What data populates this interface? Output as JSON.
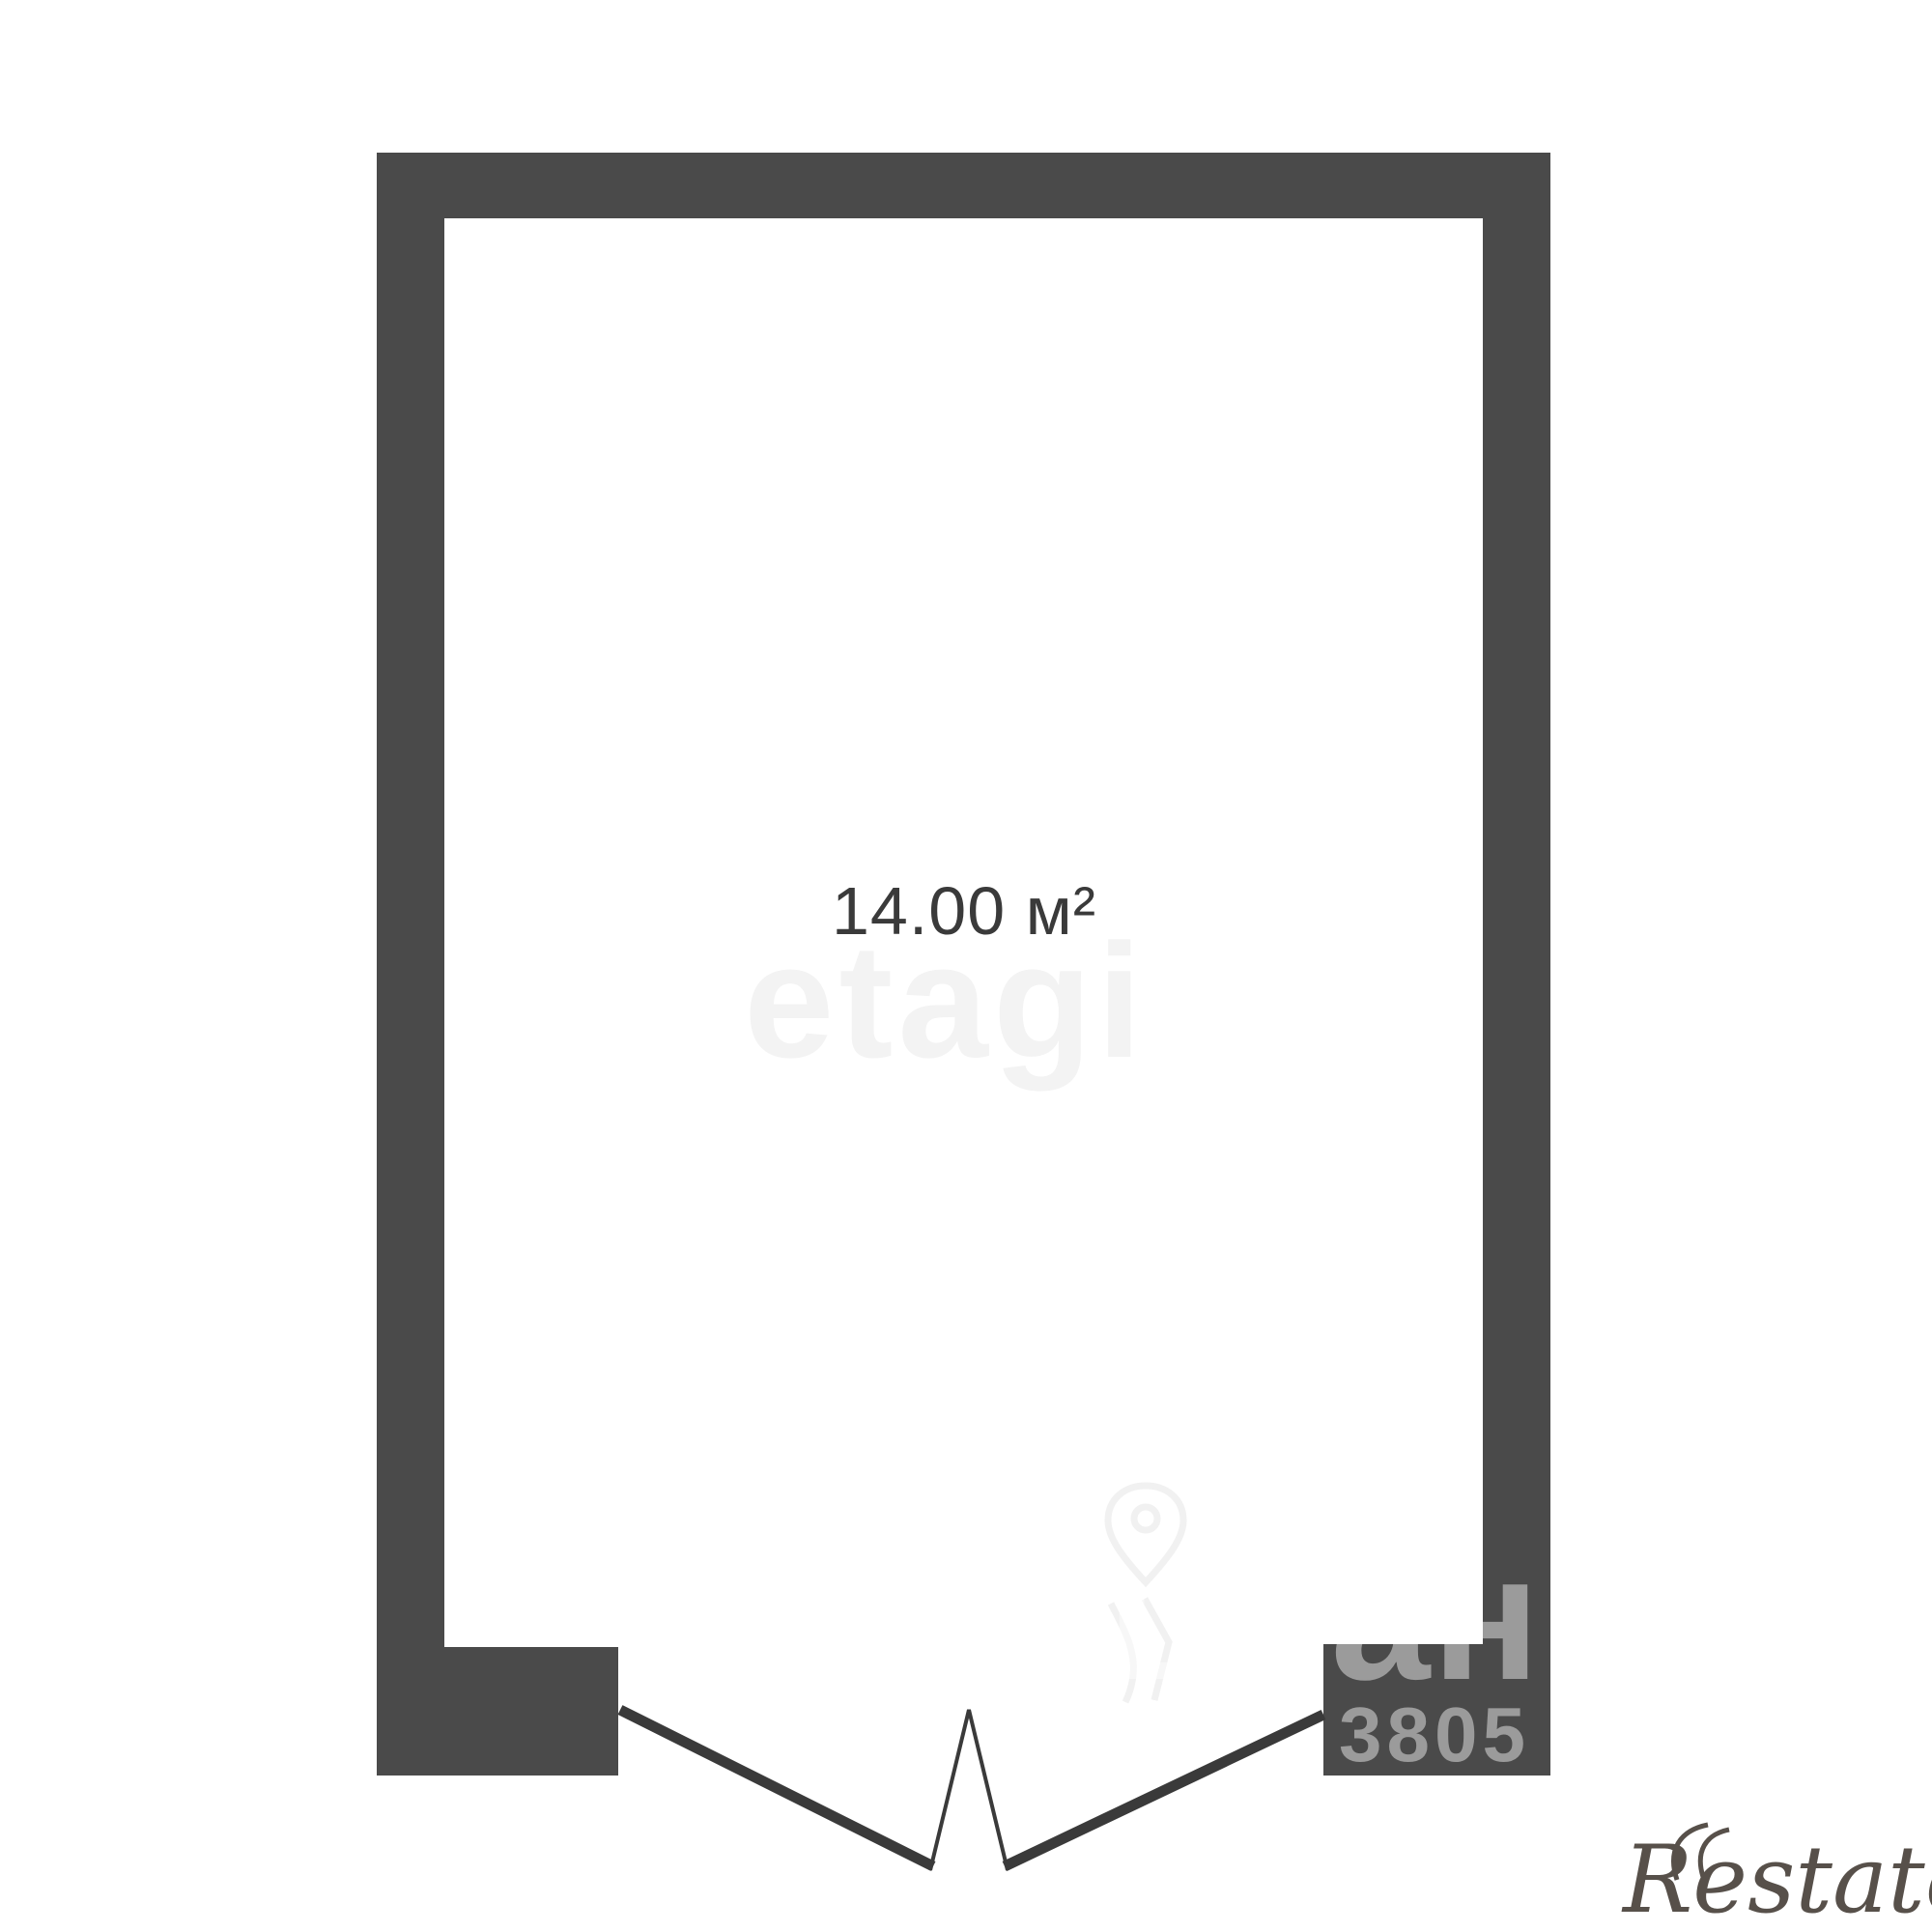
{
  "floor_plan": {
    "area_label": "14.00 м²"
  },
  "watermarks": {
    "etagi_text": "etagi",
    "cian_text": "циан",
    "cian_id": "3805",
    "restate_text": "Restate"
  },
  "colors": {
    "background": "#ffffff",
    "wall": "#4a4a4a",
    "door_line": "#3a3a3a",
    "area_text": "#3a3a3a",
    "etagi_watermark": "#f3f3f3",
    "cian_watermark_overlay": "rgba(255,255,255,0.45)",
    "restate_logo": "#57504a"
  }
}
